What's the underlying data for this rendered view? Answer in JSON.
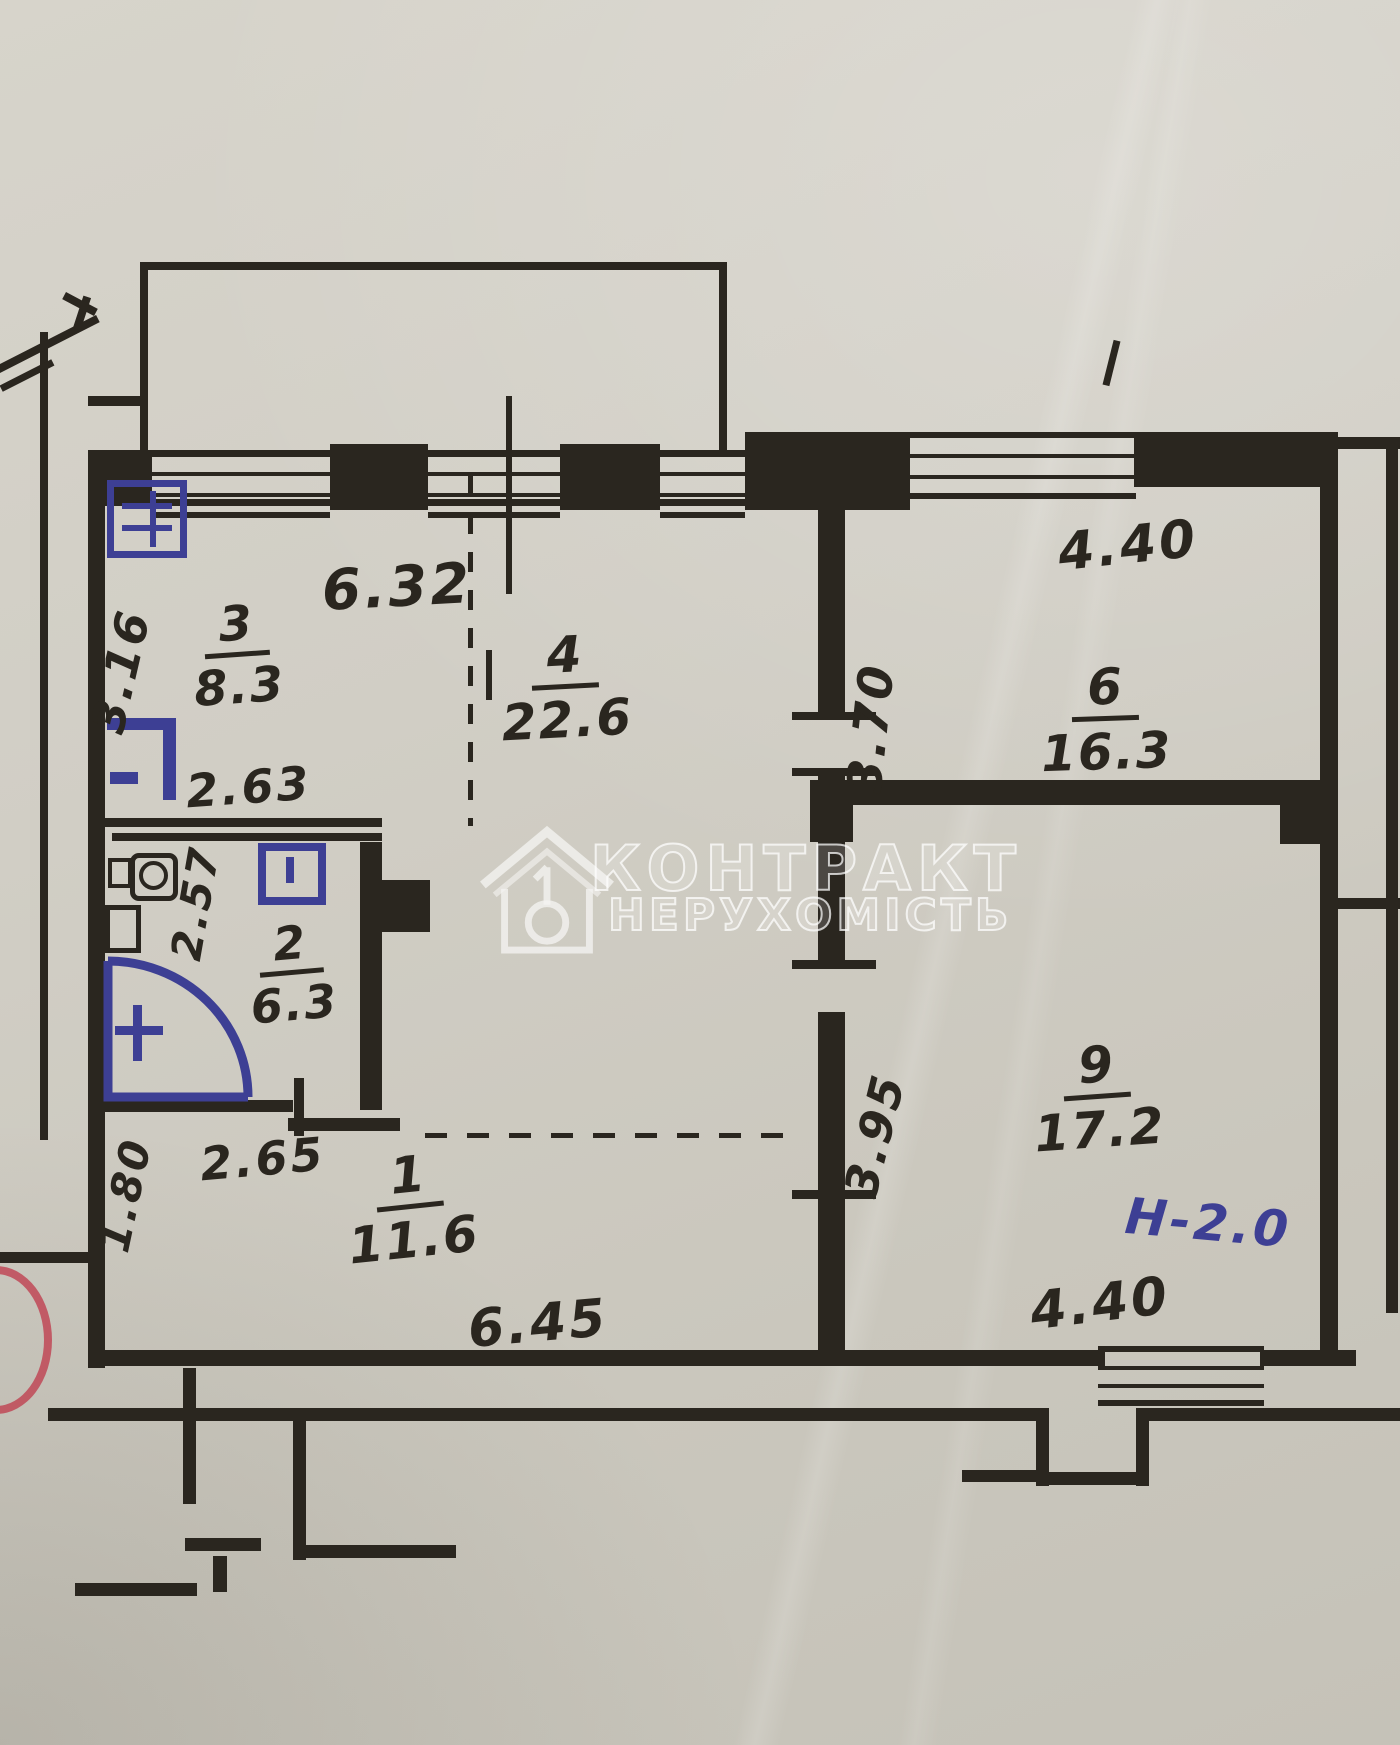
{
  "colors": {
    "ink": "#2a261f",
    "blue": "#3d3f94",
    "red": "#bf4050",
    "paper": "#d1cec5",
    "watermark": "#ffffff"
  },
  "watermark": {
    "brand": "КОНТРАКТ",
    "subtitle": "НЕРУХОМІСТЬ",
    "icon": "house-key-logo"
  },
  "rooms": [
    {
      "number": "3",
      "area": "8.3"
    },
    {
      "number": "4",
      "area": "22.6"
    },
    {
      "number": "6",
      "area": "16.3"
    },
    {
      "number": "2",
      "area": "6.3"
    },
    {
      "number": "9",
      "area": "17.2"
    },
    {
      "number": "1",
      "area": "11.6"
    }
  ],
  "dimensions": {
    "top_wall": "6.32",
    "room6_top": "4.40",
    "room6_left": "3.70",
    "room3_left": "3.16",
    "room3_bottom": "2.63",
    "room2_left": "2.57",
    "room2_bottom": "2.65",
    "hall_left": "1.80",
    "hall_bottom": "6.45",
    "room9_left": "3.95",
    "room9_bottom": "4.40"
  },
  "annotations": {
    "ceiling_height": "Н-2.0"
  }
}
